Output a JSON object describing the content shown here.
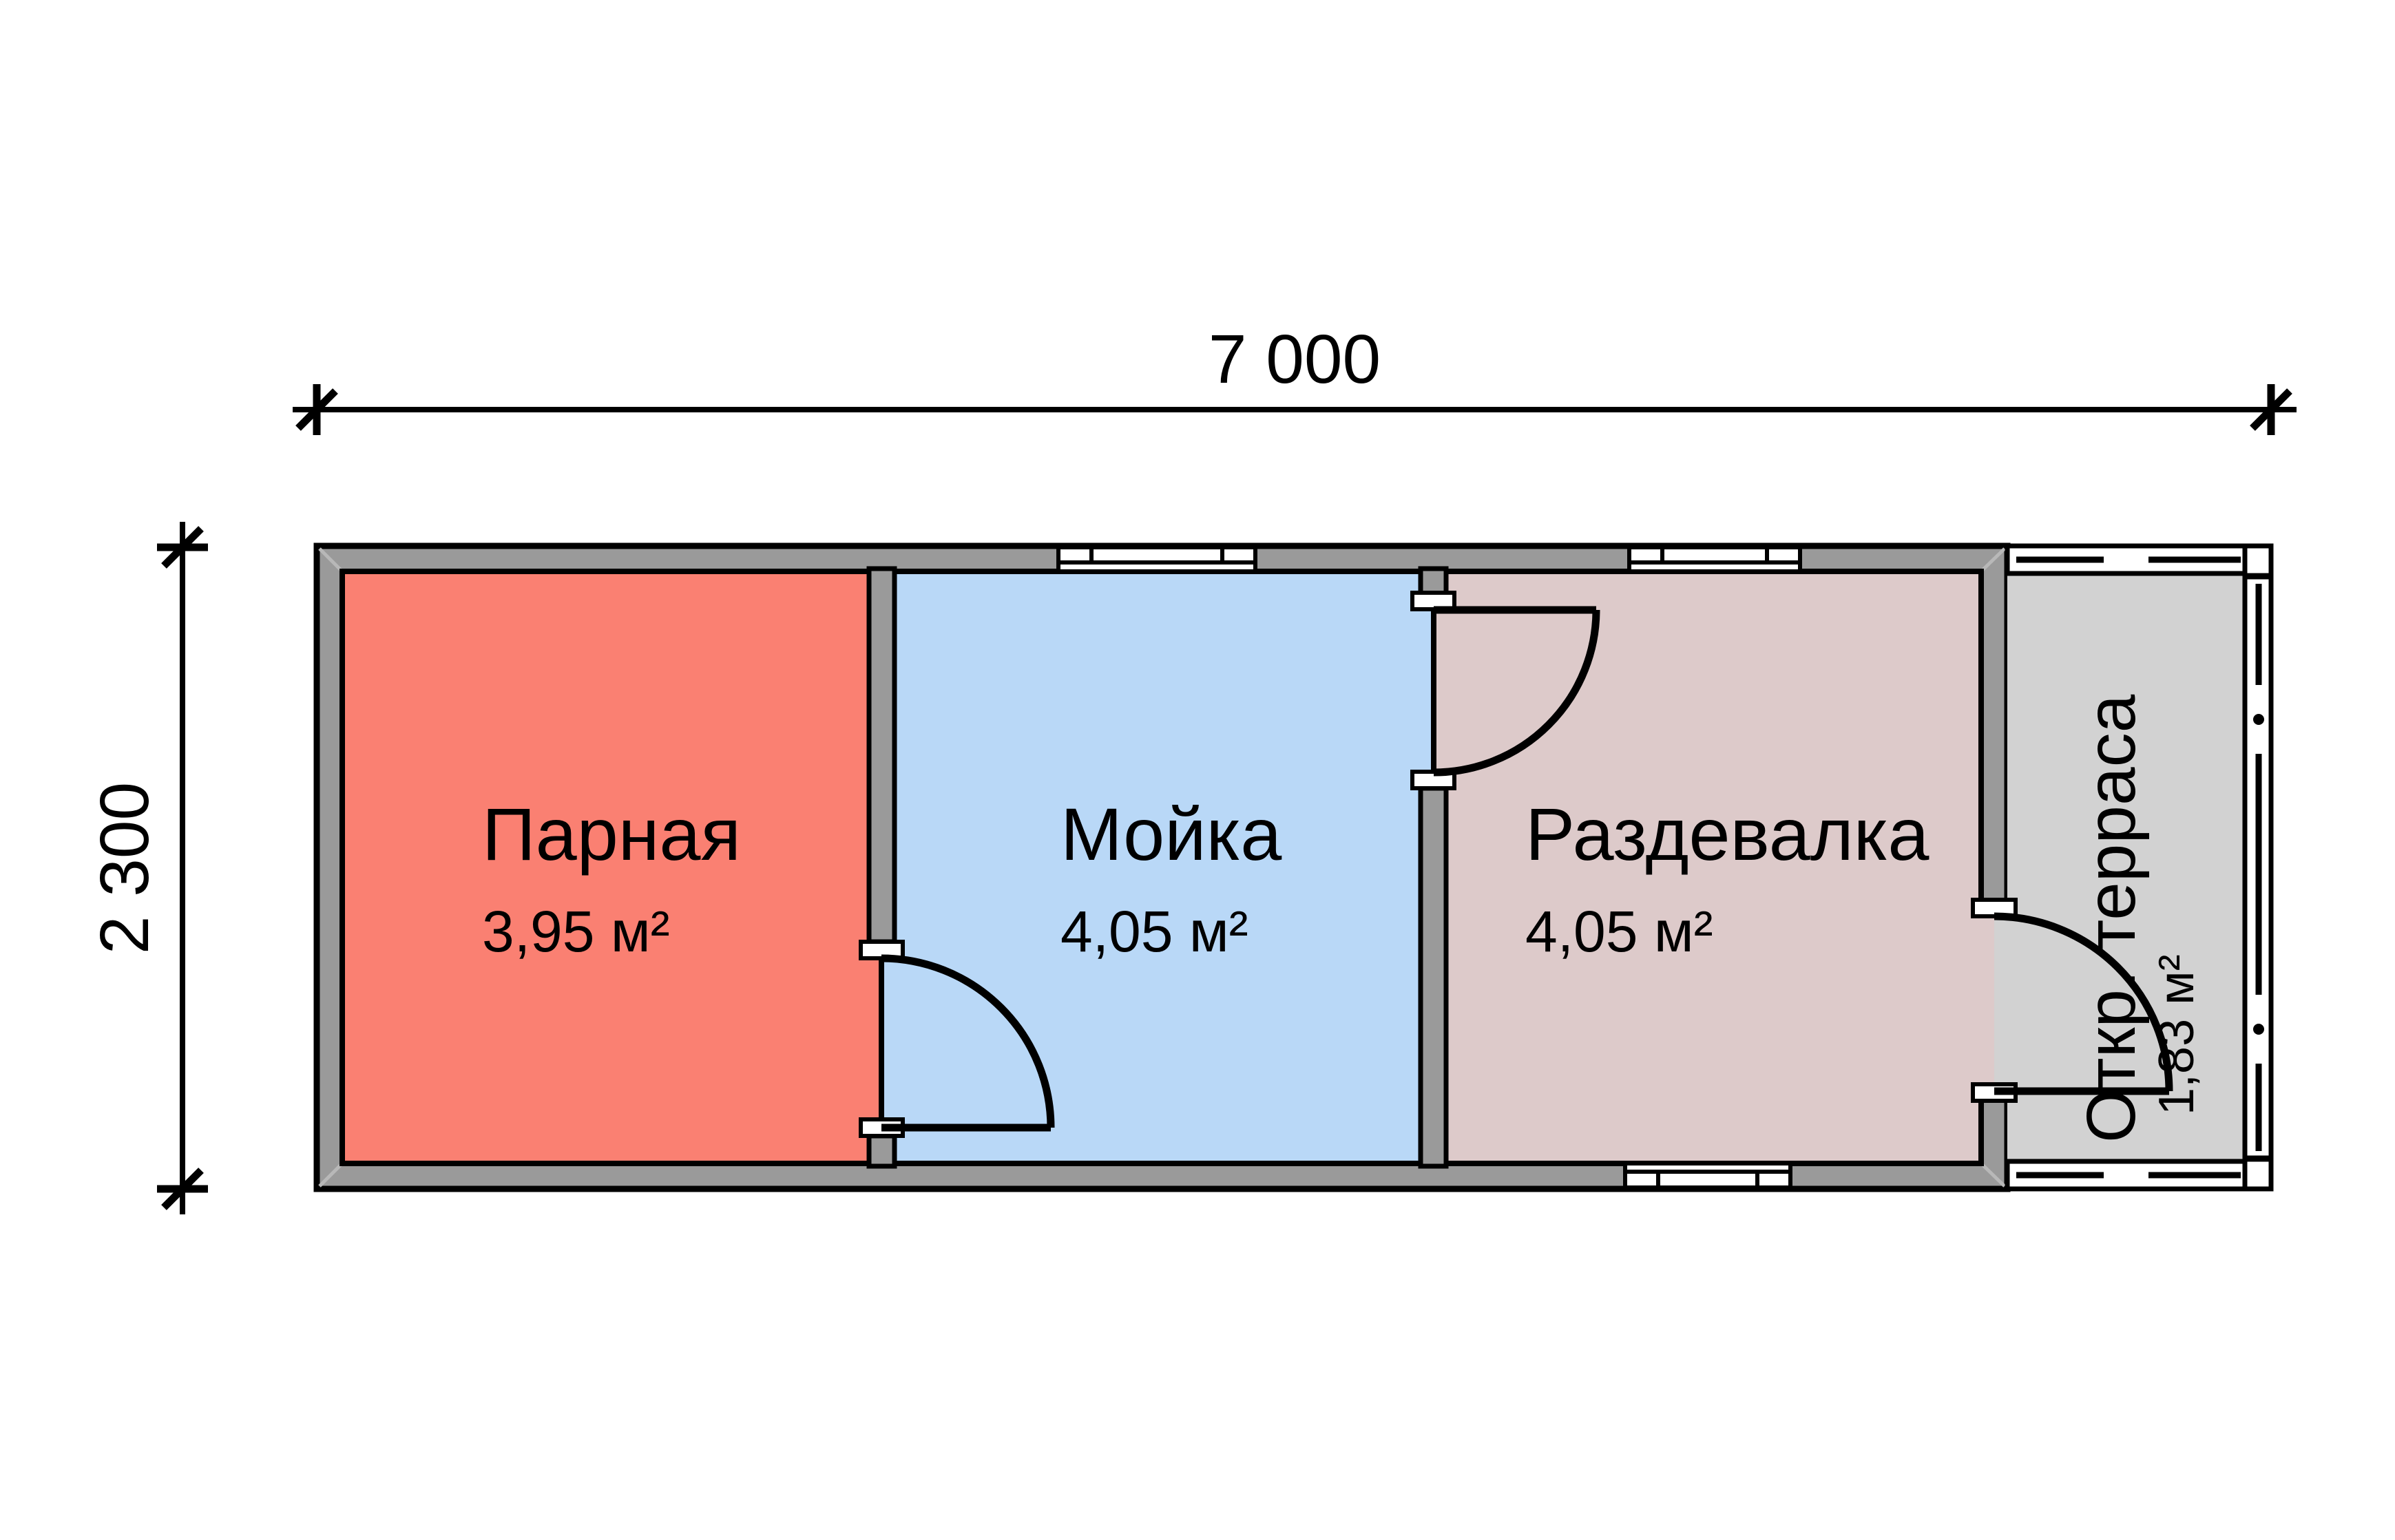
{
  "plan": {
    "title": "Floor plan of a 7000x2300 bath house",
    "dimensions": {
      "width_label": "7 000",
      "height_label": "2 300"
    },
    "rooms": [
      {
        "name": "Парная",
        "area": "3,95 м²",
        "color": "#fa8072"
      },
      {
        "name": "Мойка",
        "area": "4,05 м²",
        "color": "#b9d8f7"
      },
      {
        "name": "Раздевалка",
        "area": "4,05 м²",
        "color": "#ddcaca"
      },
      {
        "name": "Откр. терраса",
        "area": "1,83 м²",
        "color": "#d2d2d2"
      }
    ],
    "colors": {
      "wall": "#9a9a9a",
      "outline": "#000000",
      "background": "#ffffff",
      "bevel": "#b8b8b8"
    }
  }
}
